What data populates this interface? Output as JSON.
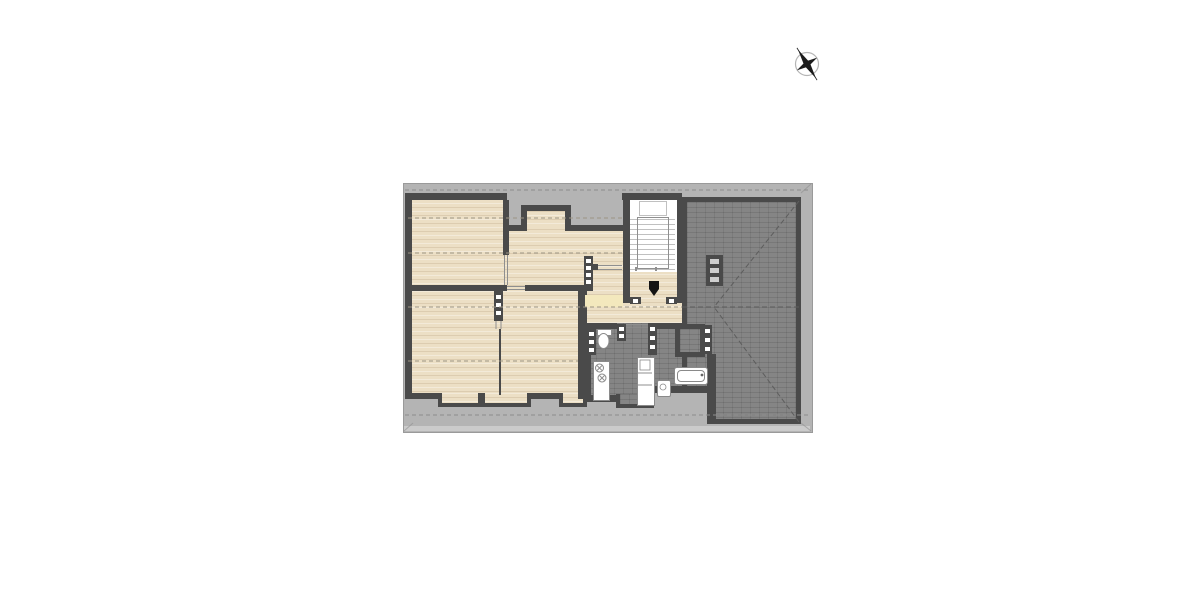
{
  "colors": {
    "page_bg": "#ffffff",
    "eave": "#b4b4b4",
    "eave_edge": "#9a9a9a",
    "eave_bottom": "#cbcbcb",
    "wall": "#4a4a4a",
    "wood": "#ecdfc5",
    "tile": "#858585",
    "stair_tread": "#c0c0c0",
    "railing": "#8f8f8f",
    "fixture_fill": "#ffffff",
    "fixture_border": "#8a8a8a",
    "wall_marker": "#ffffff",
    "chimney_marker": "#cfcfcf",
    "accent_yellow": "#f3e8bd",
    "dash_wood": "#9c9484",
    "dash_gray": "#8d8d8d",
    "dash_roof": "#5d5d5d",
    "door_marker": "#141414",
    "thin_line": "#8f8f8f",
    "compass": "#1c1c1c",
    "compass_ring": "#b5b5b5"
  },
  "icons": {
    "compass": "north-arrow-icon",
    "entrance": "door-marker-icon"
  },
  "plan": {
    "regions": [
      "room-top-left",
      "room-top-middle",
      "hallway",
      "stair-landing",
      "room-bottom-left",
      "room-bottom-middle",
      "bathroom",
      "kitchen-niche",
      "roof-area",
      "eave-band"
    ],
    "fixtures": [
      "staircase",
      "toilet",
      "shower",
      "bathtub",
      "sink",
      "stove",
      "tall-cabinet",
      "chimney",
      "dormer-notch",
      "roof-hip-lines",
      "headroom-contour-lines"
    ]
  }
}
